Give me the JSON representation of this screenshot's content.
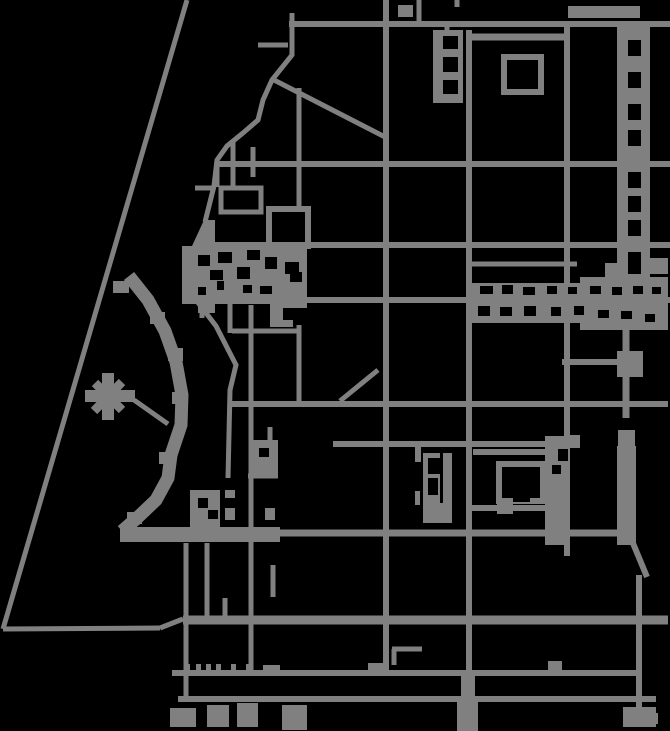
{
  "map": {
    "background": "#000000",
    "road_color": "#808080",
    "canvas": {
      "width": 670,
      "height": 731
    },
    "segments": [
      [
        187,
        0,
        3,
        629,
        5
      ],
      [
        3,
        629,
        160,
        628,
        5
      ],
      [
        160,
        628,
        183,
        619,
        5
      ],
      [
        183,
        620,
        668,
        620,
        9
      ],
      [
        289,
        24,
        670,
        24,
        6
      ],
      [
        216,
        164,
        670,
        164,
        6
      ],
      [
        217,
        164,
        217,
        187,
        5
      ],
      [
        203,
        245,
        670,
        245,
        6
      ],
      [
        185,
        300,
        670,
        300,
        6
      ],
      [
        232,
        404,
        668,
        404,
        6
      ],
      [
        333,
        444,
        566,
        444,
        6
      ],
      [
        121,
        533,
        630,
        533,
        7
      ],
      [
        172,
        673,
        639,
        673,
        6
      ],
      [
        178,
        699,
        656,
        699,
        6
      ],
      [
        386,
        0,
        386,
        673,
        6
      ],
      [
        469,
        30,
        469,
        673,
        6
      ],
      [
        567,
        22,
        567,
        556,
        6
      ],
      [
        626,
        280,
        626,
        418,
        7
      ],
      [
        630,
        536,
        647,
        577,
        6
      ],
      [
        639,
        575,
        639,
        710,
        6
      ],
      [
        419,
        0,
        419,
        23,
        5
      ],
      [
        457,
        0,
        457,
        7,
        5
      ],
      [
        258,
        45,
        288,
        45,
        5
      ],
      [
        274,
        80,
        387,
        138,
        5
      ],
      [
        299,
        88,
        299,
        209,
        5
      ],
      [
        195,
        188,
        214,
        188,
        5
      ],
      [
        233,
        140,
        233,
        188,
        5
      ],
      [
        253,
        147,
        253,
        177,
        5
      ],
      [
        202,
        305,
        202,
        318,
        5
      ],
      [
        230,
        303,
        230,
        333,
        5
      ],
      [
        232,
        331,
        299,
        331,
        5
      ],
      [
        299,
        325,
        299,
        406,
        5
      ],
      [
        340,
        401,
        378,
        370,
        5
      ],
      [
        134,
        400,
        168,
        424,
        5
      ],
      [
        467,
        264,
        577,
        264,
        5
      ],
      [
        562,
        362,
        621,
        362,
        6
      ],
      [
        470,
        37,
        567,
        37,
        7
      ],
      [
        473,
        452,
        558,
        452,
        6
      ],
      [
        470,
        508,
        545,
        508,
        6
      ],
      [
        447,
        22,
        447,
        31,
        5
      ],
      [
        394,
        665,
        394,
        649,
        5
      ],
      [
        392,
        649,
        422,
        649,
        5
      ],
      [
        251,
        305,
        251,
        673,
        5
      ],
      [
        270,
        427,
        270,
        474,
        5
      ],
      [
        248,
        476,
        278,
        476,
        5
      ],
      [
        273,
        565,
        273,
        597,
        5
      ],
      [
        186,
        543,
        186,
        700,
        5
      ],
      [
        207,
        543,
        207,
        618,
        5
      ],
      [
        225,
        598,
        225,
        618,
        5
      ],
      [
        95,
        383,
        122,
        410,
        9
      ],
      [
        122,
        382,
        94,
        411,
        9
      ]
    ],
    "polylines": [
      {
        "w": 5,
        "pts": [
          [
            292,
            13
          ],
          [
            292,
            55
          ],
          [
            272,
            80
          ],
          [
            263,
            100
          ],
          [
            258,
            120
          ],
          [
            243,
            133
          ],
          [
            227,
            146
          ],
          [
            217,
            160
          ],
          [
            214,
            186
          ],
          [
            205,
            222
          ]
        ]
      },
      {
        "w": 13,
        "pts": [
          [
            129,
            276
          ],
          [
            148,
            300
          ],
          [
            165,
            331
          ],
          [
            176,
            362
          ],
          [
            182,
            395
          ],
          [
            181,
            425
          ],
          [
            171,
            455
          ],
          [
            168,
            478
          ],
          [
            156,
            500
          ],
          [
            136,
            519
          ],
          [
            122,
            531
          ]
        ]
      },
      {
        "w": 5,
        "pts": [
          [
            196,
            300
          ],
          [
            216,
            326
          ],
          [
            236,
            365
          ],
          [
            230,
            390
          ],
          [
            228,
            478
          ]
        ]
      }
    ],
    "blocks": [
      [
        568,
        6,
        72,
        12
      ],
      [
        398,
        5,
        15,
        12
      ],
      [
        617,
        26,
        33,
        254
      ],
      [
        618,
        430,
        17,
        16
      ],
      [
        617,
        446,
        19,
        99
      ],
      [
        623,
        707,
        33,
        20
      ],
      [
        652,
        713,
        6,
        11
      ],
      [
        433,
        30,
        30,
        73
      ],
      [
        467,
        283,
        198,
        40
      ],
      [
        580,
        277,
        88,
        53
      ],
      [
        605,
        263,
        13,
        24
      ],
      [
        617,
        351,
        26,
        26
      ],
      [
        423,
        453,
        29,
        70
      ],
      [
        415,
        445,
        6,
        17
      ],
      [
        415,
        491,
        5,
        14
      ],
      [
        545,
        436,
        25,
        109
      ],
      [
        567,
        435,
        13,
        13
      ],
      [
        497,
        504,
        16,
        10
      ],
      [
        190,
        490,
        30,
        38
      ],
      [
        225,
        490,
        10,
        8
      ],
      [
        225,
        508,
        10,
        12
      ],
      [
        265,
        508,
        10,
        12
      ],
      [
        253,
        440,
        25,
        38
      ],
      [
        270,
        303,
        13,
        11
      ],
      [
        85,
        390,
        50,
        12
      ],
      [
        102,
        373,
        12,
        47
      ],
      [
        368,
        663,
        16,
        10
      ],
      [
        263,
        665,
        17,
        8
      ],
      [
        548,
        661,
        14,
        12
      ],
      [
        185,
        664,
        5,
        9
      ],
      [
        196,
        664,
        5,
        9
      ],
      [
        206,
        664,
        5,
        9
      ],
      [
        216,
        664,
        5,
        9
      ],
      [
        231,
        664,
        5,
        9
      ],
      [
        246,
        664,
        5,
        9
      ],
      [
        207,
        705,
        22,
        22
      ],
      [
        237,
        703,
        21,
        24
      ],
      [
        282,
        705,
        25,
        25
      ],
      [
        170,
        708,
        26,
        19
      ],
      [
        461,
        673,
        14,
        27
      ],
      [
        457,
        700,
        21,
        31
      ],
      [
        648,
        258,
        20,
        16
      ],
      [
        113,
        281,
        16,
        12
      ],
      [
        150,
        312,
        15,
        12
      ],
      [
        168,
        348,
        15,
        13
      ],
      [
        172,
        392,
        15,
        12
      ],
      [
        159,
        452,
        13,
        12
      ],
      [
        127,
        512,
        15,
        12
      ],
      [
        120,
        527,
        160,
        15
      ]
    ],
    "polygons": [
      [
        [
          182,
          246
        ],
        [
          307,
          246
        ],
        [
          307,
          308
        ],
        [
          270,
          308
        ],
        [
          270,
          304
        ],
        [
          215,
          304
        ],
        [
          215,
          313
        ],
        [
          198,
          313
        ],
        [
          198,
          304
        ],
        [
          182,
          304
        ]
      ],
      [
        [
          192,
          246
        ],
        [
          204,
          220
        ],
        [
          215,
          220
        ],
        [
          215,
          246
        ]
      ],
      [
        [
          270,
          313
        ],
        [
          283,
          313
        ],
        [
          283,
          320
        ],
        [
          293,
          320
        ],
        [
          293,
          327
        ],
        [
          270,
          327
        ]
      ]
    ],
    "outlines": [
      [
        221,
        188,
        40,
        24,
        5
      ],
      [
        269,
        209,
        39,
        37,
        6
      ],
      [
        504,
        57,
        37,
        35,
        6
      ],
      [
        499,
        464,
        44,
        37,
        6
      ]
    ],
    "gaps": [
      [
        628,
        40,
        13,
        16
      ],
      [
        628,
        72,
        13,
        16
      ],
      [
        628,
        104,
        13,
        16
      ],
      [
        628,
        130,
        13,
        16
      ],
      [
        628,
        172,
        13,
        16
      ],
      [
        628,
        196,
        13,
        16
      ],
      [
        628,
        220,
        13,
        16
      ],
      [
        628,
        252,
        13,
        22
      ],
      [
        480,
        286,
        13,
        8
      ],
      [
        502,
        285,
        11,
        9
      ],
      [
        523,
        287,
        12,
        8
      ],
      [
        547,
        286,
        10,
        8
      ],
      [
        568,
        287,
        9,
        7
      ],
      [
        590,
        286,
        11,
        8
      ],
      [
        612,
        287,
        10,
        8
      ],
      [
        633,
        286,
        10,
        8
      ],
      [
        652,
        287,
        9,
        7
      ],
      [
        478,
        306,
        12,
        10
      ],
      [
        500,
        307,
        12,
        9
      ],
      [
        524,
        306,
        12,
        10
      ],
      [
        551,
        307,
        10,
        9
      ],
      [
        574,
        306,
        10,
        9
      ],
      [
        598,
        310,
        11,
        8
      ],
      [
        621,
        311,
        11,
        8
      ],
      [
        645,
        314,
        10,
        8
      ],
      [
        198,
        255,
        12,
        11
      ],
      [
        218,
        252,
        14,
        11
      ],
      [
        247,
        250,
        13,
        10
      ],
      [
        210,
        270,
        13,
        10
      ],
      [
        237,
        267,
        13,
        12
      ],
      [
        265,
        257,
        12,
        12
      ],
      [
        285,
        262,
        14,
        12
      ],
      [
        198,
        287,
        8,
        8
      ],
      [
        217,
        281,
        7,
        9
      ],
      [
        243,
        285,
        9,
        8
      ],
      [
        260,
        286,
        12,
        8
      ],
      [
        290,
        272,
        12,
        10
      ],
      [
        443,
        36,
        15,
        13
      ],
      [
        443,
        57,
        15,
        15
      ],
      [
        443,
        80,
        15,
        14
      ],
      [
        428,
        458,
        12,
        16
      ],
      [
        428,
        478,
        10,
        17
      ],
      [
        440,
        453,
        3,
        50
      ],
      [
        552,
        465,
        9,
        9
      ],
      [
        558,
        449,
        10,
        12
      ],
      [
        513,
        495,
        17,
        7
      ],
      [
        198,
        498,
        10,
        10
      ],
      [
        208,
        510,
        10,
        9
      ],
      [
        259,
        448,
        10,
        9
      ]
    ]
  }
}
